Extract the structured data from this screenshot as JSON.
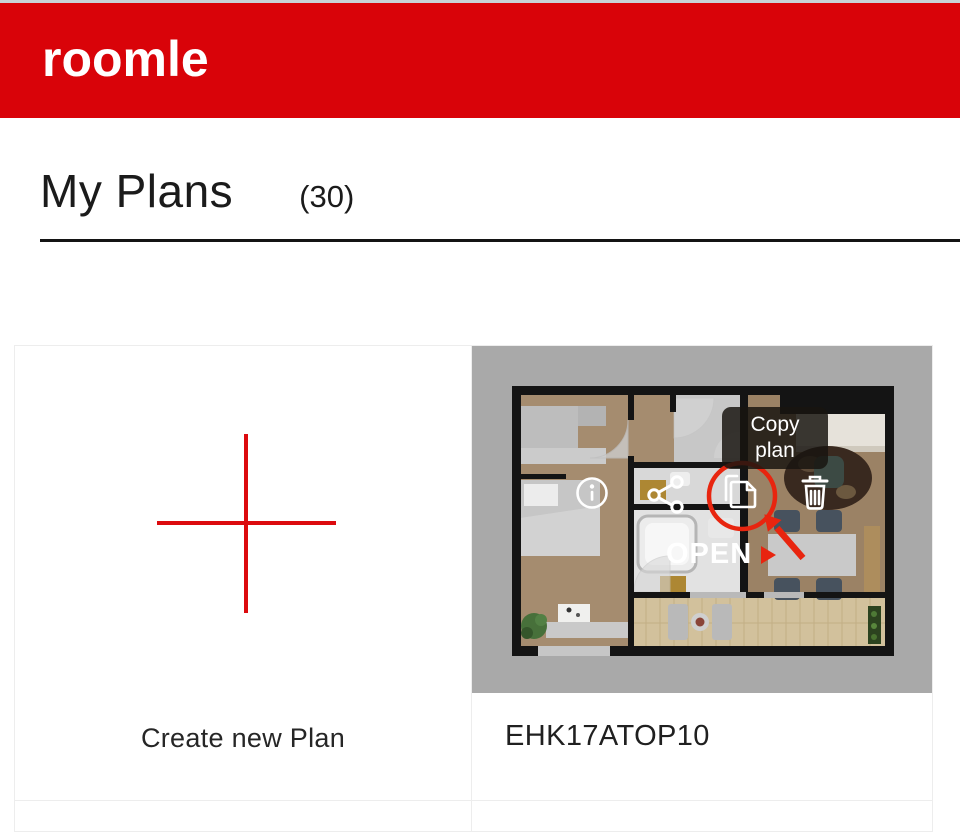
{
  "header": {
    "logo_text": "roomle"
  },
  "page": {
    "title": "My Plans",
    "count": "(30)"
  },
  "create_card": {
    "label": "Create new Plan"
  },
  "plan_card": {
    "title": "EHK17ATOP10",
    "open_label": "OPEN",
    "tooltip": {
      "line1": "Copy",
      "line2": "plan"
    },
    "action_icons": [
      "info-icon",
      "share-icon",
      "copy-icon",
      "trash-icon"
    ]
  },
  "colors": {
    "brand_red": "#d90309",
    "plus_red": "#dc0a0e",
    "annotation_red": "#e8250f",
    "thumbnail_gray": "#a9a9a9",
    "heading_text": "#1b1b1b"
  }
}
